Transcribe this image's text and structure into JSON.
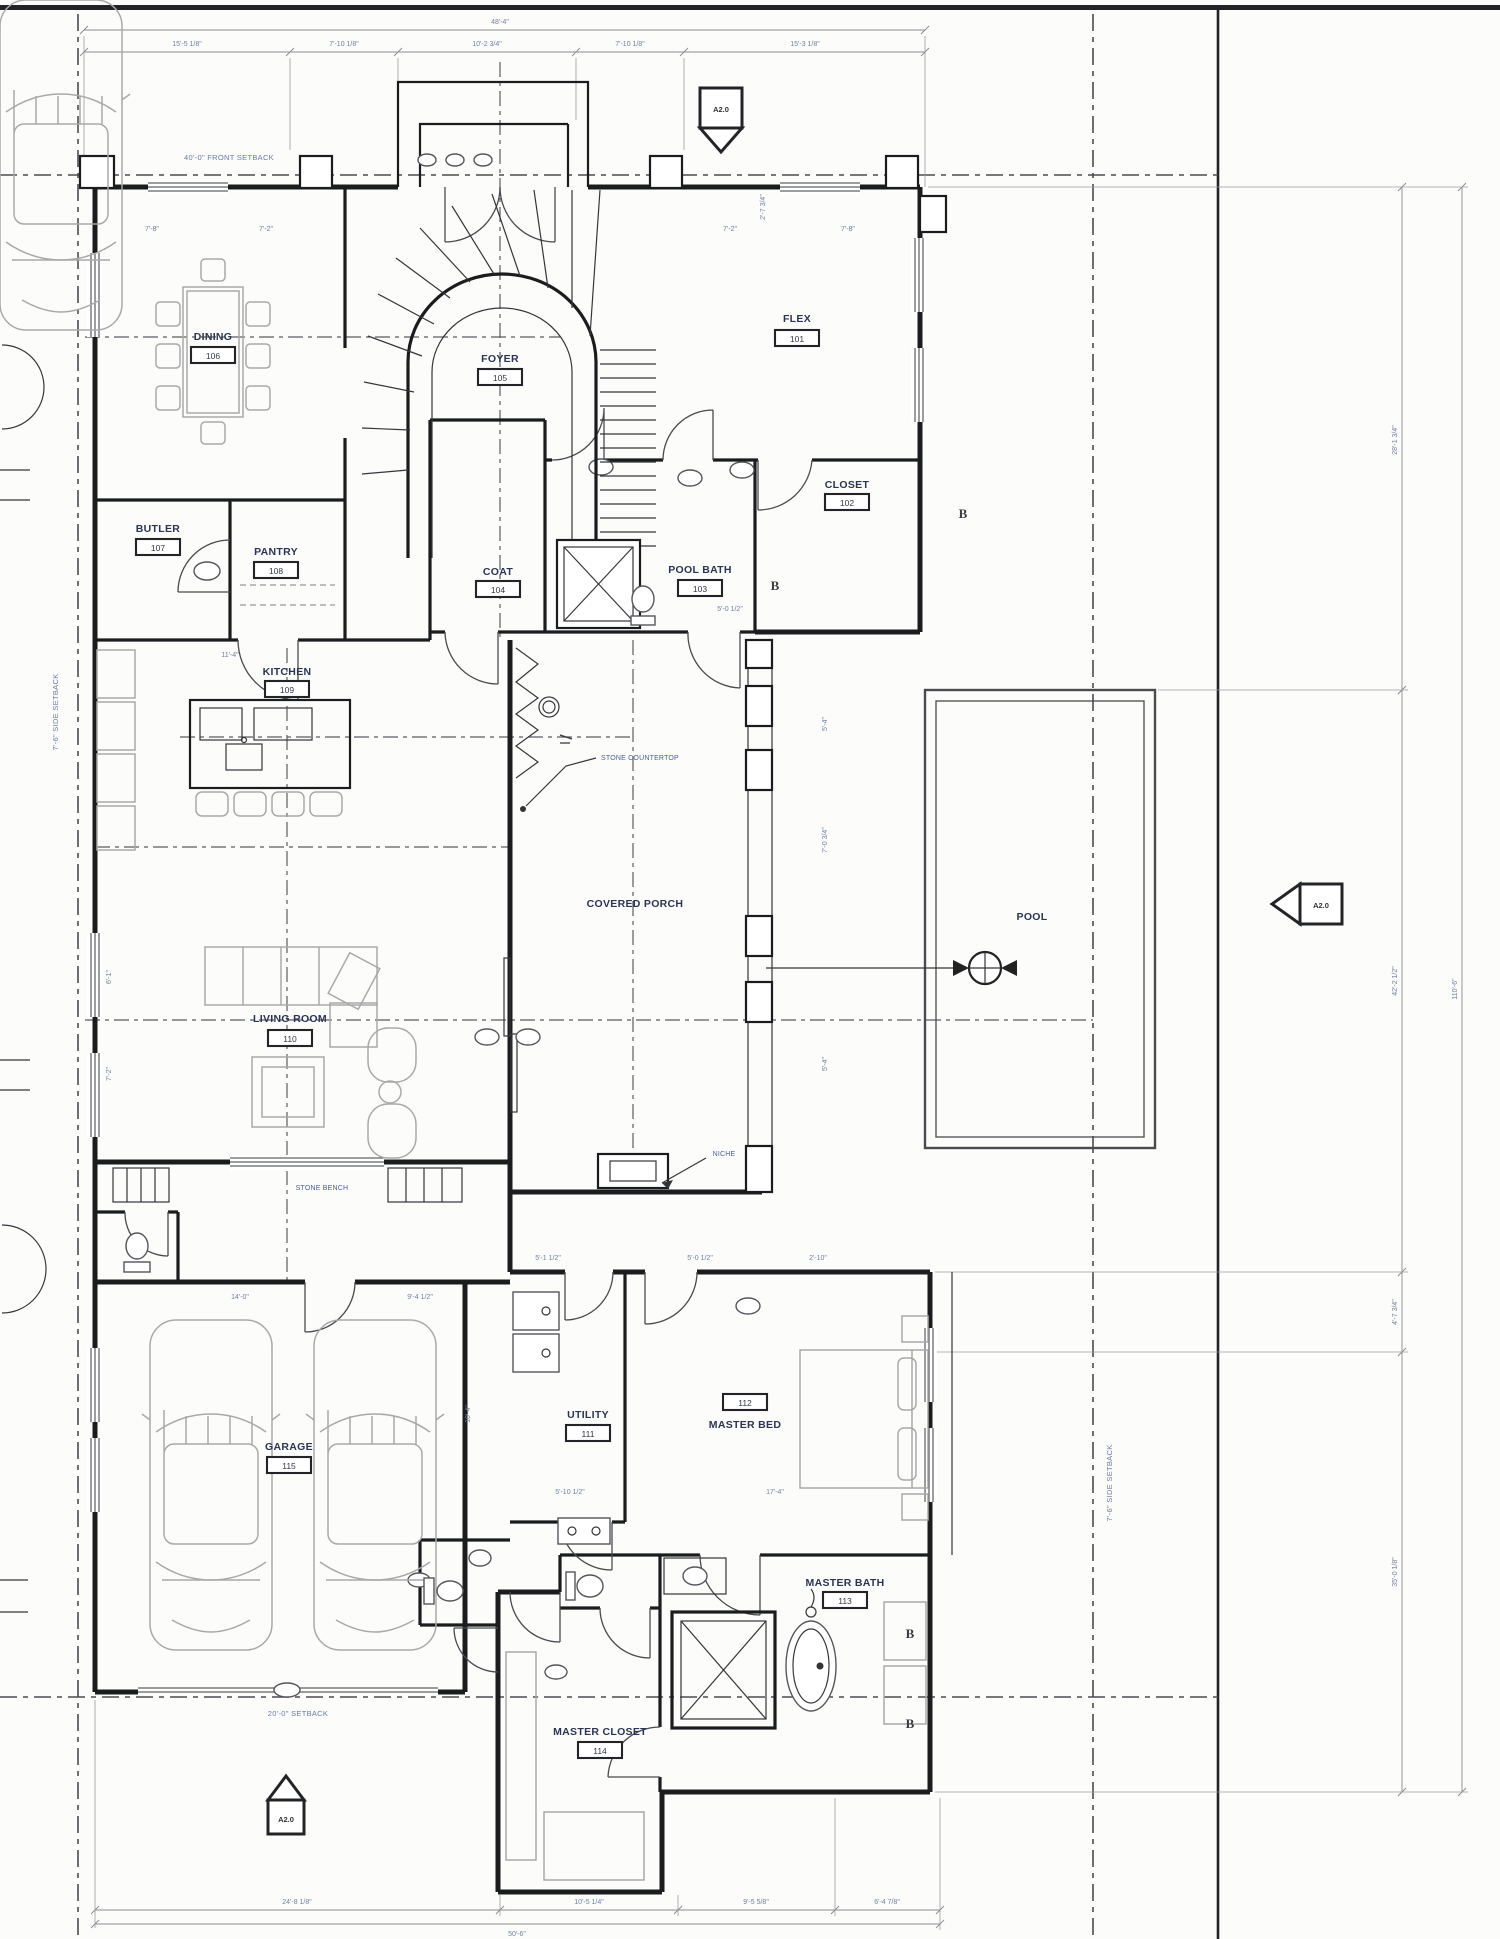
{
  "sheet": {
    "bg": "#fcfcfb",
    "ink": "#1b1c1e",
    "room_label_color": "#2b3453",
    "dim_color": "#71809f",
    "setback_color": "#6a79a8"
  },
  "setbacks": {
    "front": "40'-0\" FRONT SETBACK",
    "left": "7'-6\" SIDE SETBACK",
    "right": "7'-6\" SIDE SETBACK",
    "rear": "20'-0\" SETBACK"
  },
  "rooms": [
    {
      "name": "DINING",
      "number": "106"
    },
    {
      "name": "FOYER",
      "number": "105"
    },
    {
      "name": "FLEX",
      "number": "101"
    },
    {
      "name": "CLOSET",
      "number": "102"
    },
    {
      "name": "POOL BATH",
      "number": "103"
    },
    {
      "name": "COAT",
      "number": "104"
    },
    {
      "name": "BUTLER",
      "number": "107"
    },
    {
      "name": "PANTRY",
      "number": "108"
    },
    {
      "name": "KITCHEN",
      "number": "109"
    },
    {
      "name": "LIVING ROOM",
      "number": "110"
    },
    {
      "name": "GARAGE",
      "number": "115"
    },
    {
      "name": "UTILITY",
      "number": "111"
    },
    {
      "name": "MASTER BED",
      "number": "112"
    },
    {
      "name": "MASTER BATH",
      "number": "113"
    },
    {
      "name": "MASTER CLOSET",
      "number": "114"
    }
  ],
  "labels": {
    "covered_porch": "COVERED PORCH",
    "pool": "POOL"
  },
  "annotations": {
    "stone_countertop": "STONE COUNTERTOP",
    "niche": "NICHE",
    "stone_bench": "STONE BENCH"
  },
  "markers": {
    "elevation": "A2.0",
    "section": "B"
  },
  "dims": {
    "top_overall": "48'-4\"",
    "top_segments": [
      "15'-5 1/8\"",
      "7'-10 1/8\"",
      "10'-2 3/4\"",
      "7'-10 1/8\"",
      "15'-3 1/8\""
    ],
    "bottom_overall": "50'-6\"",
    "bottom_segments": [
      "24'-8 1/8\"",
      "10'-5 1/4\"",
      "9'-5 5/8\"",
      "6'-4 7/8\""
    ],
    "right_overall": "110'-6\"",
    "right_segments": [
      "28'-1 3/4\"",
      "42'-2 1/2\"",
      "4'-7 3/4\"",
      "35'-0 1/8\""
    ],
    "small": [
      "7'-8\"",
      "7'-2\"",
      "7'-2\"",
      "7'-8\"",
      "2'-7 3/4\"",
      "11'-4\"",
      "5'-4\"",
      "7'-0 3/4\"",
      "5'-4\"",
      "6'-1\"",
      "7'-2\"",
      "17'-4\"",
      "5'-10 1/2\"",
      "10'-4\"",
      "5'-1 1/2\"",
      "5'-0 1/2\"",
      "2'-10\"",
      "5'-0 1/2\"",
      "14'-0\"",
      "9'-4 1/2\""
    ]
  }
}
